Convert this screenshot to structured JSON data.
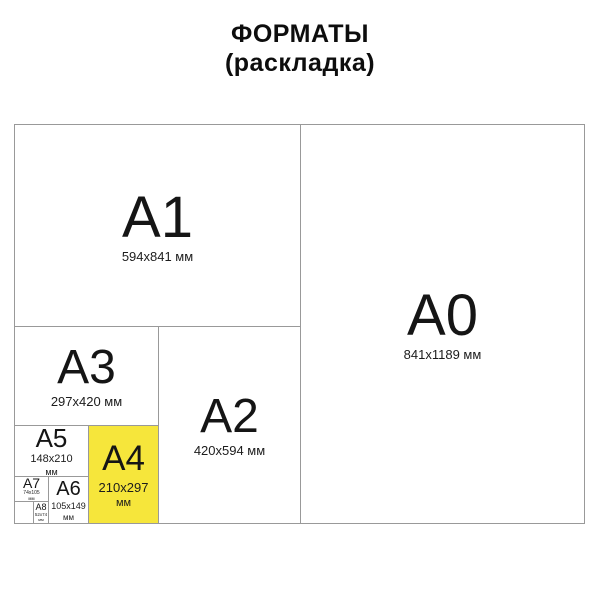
{
  "title": {
    "line1": "ФОРМАТЫ",
    "line2": "(раскладка)"
  },
  "formats": {
    "a0": {
      "name": "A0",
      "size": "841x1189 мм"
    },
    "a1": {
      "name": "A1",
      "size": "594x841 мм"
    },
    "a2": {
      "name": "A2",
      "size": "420x594 мм"
    },
    "a3": {
      "name": "A3",
      "size": "297x420 мм"
    },
    "a4": {
      "name": "A4",
      "size": "210x297",
      "unit": "мм"
    },
    "a5": {
      "name": "A5",
      "size": "148x210",
      "unit": "мм"
    },
    "a6": {
      "name": "A6",
      "size": "105x149",
      "unit": "мм"
    },
    "a7": {
      "name": "A7",
      "size": "74x105",
      "unit": "мм"
    },
    "a8": {
      "name": "A8",
      "size": "52x74",
      "unit": "мм"
    }
  },
  "colors": {
    "highlight": "#f6e63b",
    "border": "#999999",
    "text": "#111111",
    "background": "#ffffff"
  }
}
